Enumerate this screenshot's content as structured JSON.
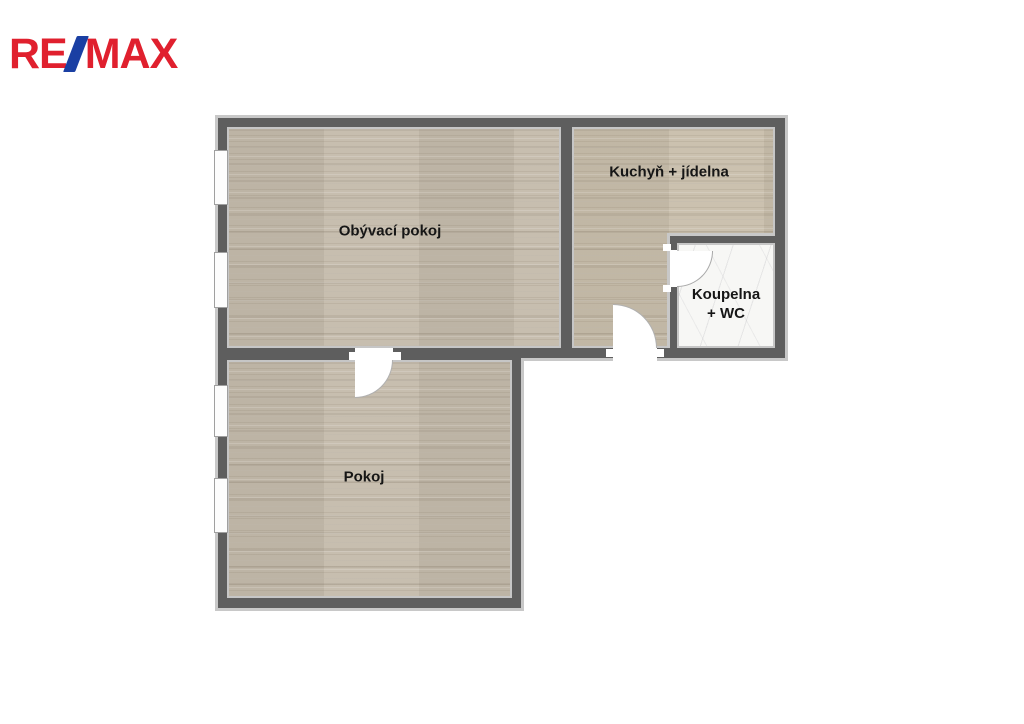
{
  "logo": {
    "re": "RE",
    "slash_symbol": "/",
    "max": "MAX"
  },
  "colors": {
    "logo_red": "#E0202E",
    "logo_blue": "#1A3FA3",
    "wall_dark": "#5E5E5E",
    "wall_edge": "#C8C8C8",
    "wood_floor": "#C4BBAB",
    "marble_floor": "#F7F7F5",
    "label_text": "#161616",
    "background": "#FFFFFF"
  },
  "rooms": {
    "living": {
      "label": "Obývací pokoj"
    },
    "kitchen": {
      "label": "Kuchyň + jídelna"
    },
    "bathroom": {
      "label_line1": "Koupelna",
      "label_line2": "+ WC"
    },
    "bedroom": {
      "label": "Pokoj"
    }
  }
}
